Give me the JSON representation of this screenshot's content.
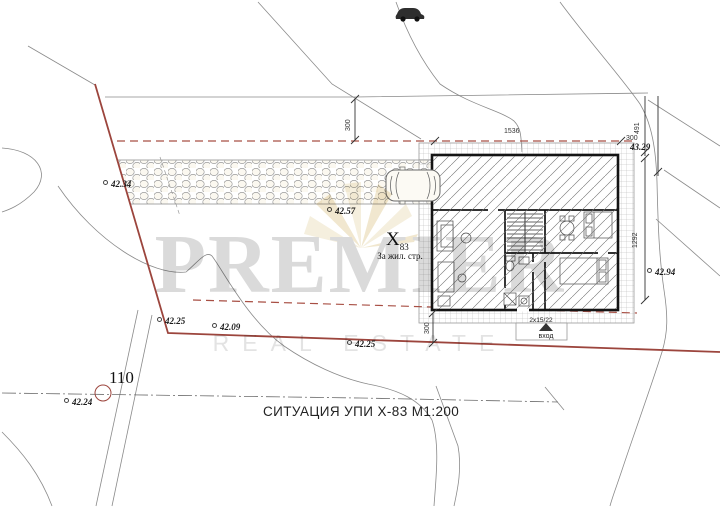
{
  "title": "СИТУАЦИЯ УПИ Х-83 М1:200",
  "watermark": {
    "brand": "PREMIER",
    "tagline": "REAL ESTATE"
  },
  "parcel": {
    "number": "X",
    "number_sub": "83",
    "designation": "За жил. стр."
  },
  "plot_point": "110",
  "entrance": {
    "steps_note": "2x15/22",
    "label": "вход"
  },
  "elevations": {
    "northwest": "42.34",
    "driveway": "42.57",
    "west_upper": "42.25",
    "west_lower": "42.09",
    "south": "42.25",
    "southwest": "42.24",
    "east": "42.94",
    "northeast_corner": "43.29"
  },
  "dimensions": {
    "north_setback": "300",
    "north_frontage": "1536",
    "northeast_side": "491",
    "northeast_offset": "300",
    "east_depth": "1292",
    "south_setback": "300"
  },
  "colors": {
    "boundary_red": "#9c453d",
    "wall_black": "#141414",
    "watermark_gray": "#d4d4d4",
    "logo_gold": "#e3d2a4"
  }
}
